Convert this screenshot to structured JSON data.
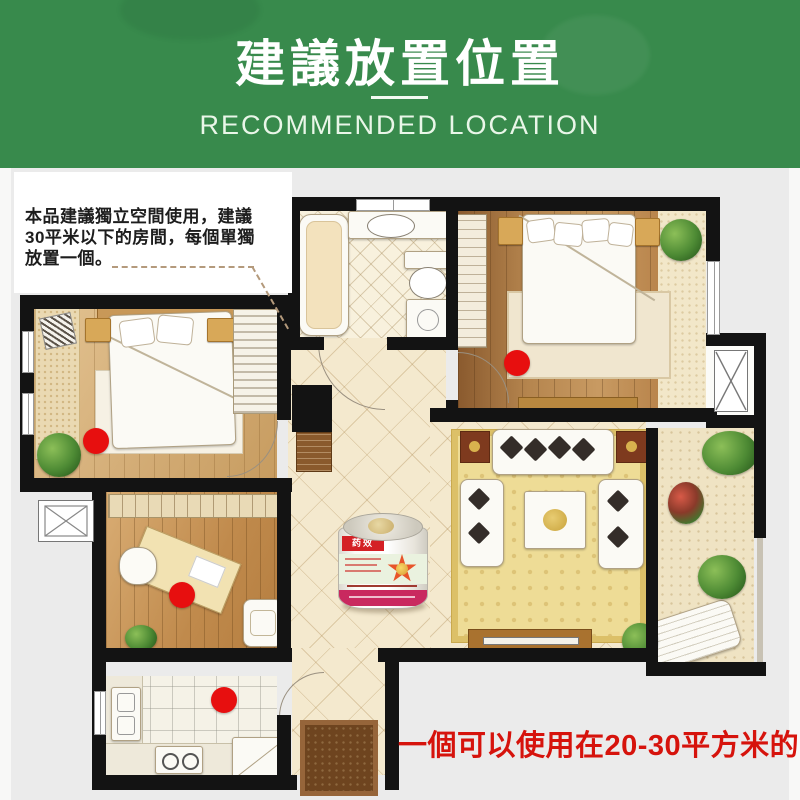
{
  "banner": {
    "title": "建議放置位置",
    "subtitle": "RECOMMENDED LOCATION",
    "bg_color": "#388a4c",
    "text_color": "#ffffff"
  },
  "tip": {
    "line1": "本品建議獨立空間使用，建議",
    "line2": "30平米以下的房間，每個單獨",
    "line3": "放置一個。"
  },
  "caption": {
    "text": "一個可以使用在20-30平方米的空間",
    "color": "#d6130c"
  },
  "product_can": {
    "brand_label": "药效"
  },
  "floorplan": {
    "dot_color": "#e70f0f",
    "dots": [
      {
        "x": 96,
        "y": 441
      },
      {
        "x": 182,
        "y": 595
      },
      {
        "x": 224,
        "y": 700
      },
      {
        "x": 517,
        "y": 363
      }
    ]
  }
}
